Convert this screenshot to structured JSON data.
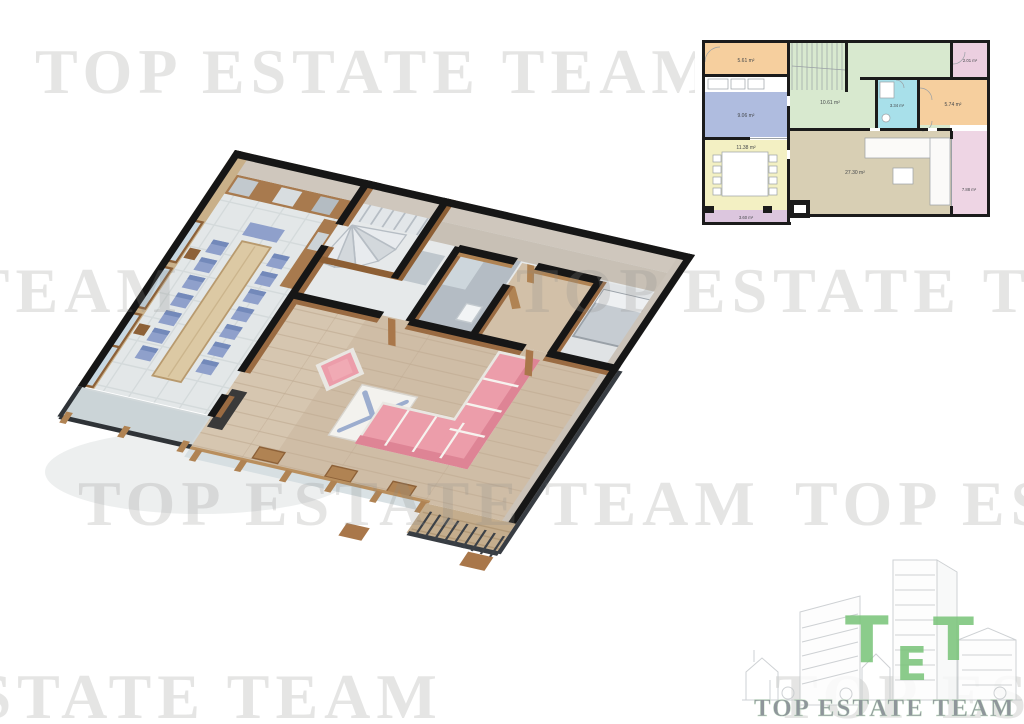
{
  "watermark": {
    "text": "TOP ESTATE TEAM",
    "color": "#8c8c8a"
  },
  "logo": {
    "t1": "T",
    "t2": "E",
    "t3": "T",
    "monogram_color": "#7cc57c",
    "name": "TOP ESTATE TEAM",
    "name_color": "#8f969b",
    "art_color": "#c6cacd"
  },
  "plan2d": {
    "wall_color": "#1b1b1b",
    "furniture_color": "#8a8f94",
    "rooms": [
      {
        "id": "entry",
        "area": "5.61 m²",
        "color": "#f6cf9e"
      },
      {
        "id": "stair-hall",
        "area": "10.61 m²",
        "color": "#d8e9cf"
      },
      {
        "id": "wc",
        "area": "2.01 m²",
        "color": "#eccfe0"
      },
      {
        "id": "bathroom",
        "area": "3.34 m²",
        "color": "#a8e0ea"
      },
      {
        "id": "bedroom",
        "area": "5.74 m²",
        "color": "#f6cf9e"
      },
      {
        "id": "kitchen",
        "area": "9.06 m²",
        "color": "#afbcdf"
      },
      {
        "id": "dining",
        "area": "11.38 m²",
        "color": "#f3f0c3"
      },
      {
        "id": "living",
        "area": "27.30 m²",
        "color": "#d8cfb4"
      },
      {
        "id": "terrace-right",
        "area": "7.88 m²",
        "color": "#eed5e4"
      },
      {
        "id": "terrace-bottom",
        "area": "3.60 m²",
        "color": "#dcc6de"
      }
    ]
  },
  "palette": {
    "wall_top": "#161616",
    "wall_cream": "#cfc7bd",
    "wall_cream_dark": "#c8c0b5",
    "wood_dark": "#8d5f35",
    "wood_mid": "#9a6b42",
    "wood_light": "#b08353",
    "floor_tile": "#e3e7e8",
    "floor_wood": "#cfbda6",
    "stair_gray": "#e2e6e9",
    "bath_floor": "#b4bcc4",
    "sofa_pink": "#ec9daa",
    "sofa_pink_dark": "#de8495",
    "chair_blue": "#8fa0cb",
    "glass": "#c8d8e2",
    "metal": "#383d43",
    "deck_wood": "#c4ad8d"
  }
}
